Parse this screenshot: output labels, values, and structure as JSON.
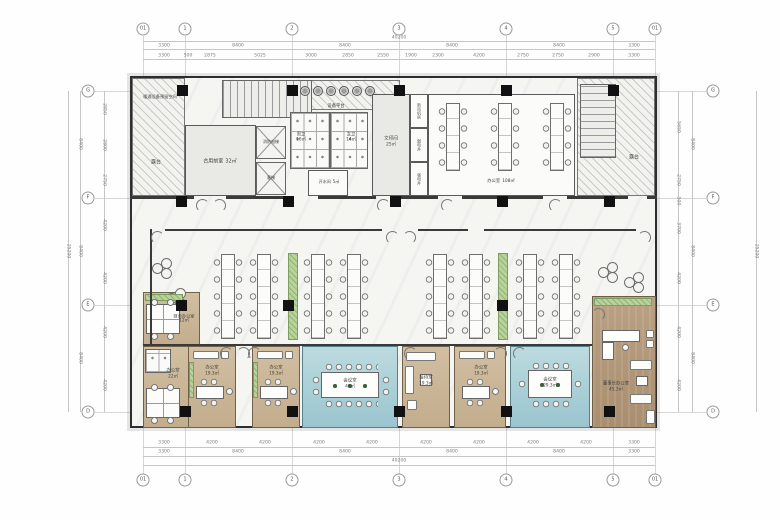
{
  "grid": {
    "top": [
      "01",
      "1",
      "2",
      "3",
      "4",
      "5",
      "01"
    ],
    "bottom": [
      "01",
      "1",
      "2",
      "3",
      "4",
      "5",
      "01"
    ],
    "left": [
      "G",
      "F",
      "E",
      "D"
    ],
    "right": [
      "G",
      "F",
      "E",
      "D"
    ]
  },
  "dims": {
    "top_total": "40200",
    "top_major": [
      "3300",
      "8400",
      "8400",
      "8400",
      "8400",
      "3300"
    ],
    "top_minor": [
      "3300",
      "500",
      "2875",
      "5025",
      "3000",
      "2850",
      "2550",
      "1900",
      "2300",
      "4200",
      "2750",
      "2750",
      "2900",
      "3300"
    ],
    "bottom_minor": [
      "3300",
      "4200",
      "4200",
      "4200",
      "4200",
      "4200",
      "4200",
      "4200",
      "4200",
      "3300"
    ],
    "bottom_major": [
      "3300",
      "8400",
      "8400",
      "8400",
      "8400",
      "3300"
    ],
    "bottom_total": "40200",
    "left_total": "25200",
    "left_major": [
      "8400",
      "8400",
      "8400"
    ],
    "left_minor": [
      "2850",
      "2800",
      "2750",
      "4200",
      "4200",
      "4200",
      "4200"
    ],
    "right_minor": [
      "5650",
      "2750",
      "500",
      "3700",
      "4200",
      "4200",
      "4200"
    ],
    "right_major": [
      "8400",
      "8400",
      "8400"
    ],
    "right_total": "25200"
  },
  "rooms": {
    "hvac_reserve": {
      "name": "暖通设备预留空间"
    },
    "terrace_left": {
      "name": "露台"
    },
    "shared_lobby": {
      "name": "合用前室",
      "area": "32㎡"
    },
    "fire_elevator": {
      "name": "消防电梯"
    },
    "passenger_elevator": {
      "name": "客梯"
    },
    "equipment_platform": {
      "name": "设备平台"
    },
    "mens_toilet": {
      "name": "男卫",
      "area": "16㎡"
    },
    "womens_toilet": {
      "name": "女卫",
      "area": "14㎡"
    },
    "hot_water": {
      "name": "开水间",
      "area": "5㎡"
    },
    "print_room": {
      "name": "文印间",
      "area": "25㎡"
    },
    "fresh_air": {
      "name": "新风机房"
    },
    "weak_power": {
      "name": "弱电井"
    },
    "strong_power": {
      "name": "强电井"
    },
    "office_top": {
      "name": "办公室",
      "area": "108㎡"
    },
    "terrace_right": {
      "name": "露台"
    },
    "finance_office": {
      "name": "财务办公室",
      "area": "12㎡"
    },
    "office_left": {
      "name": "办公室",
      "area": "22㎡"
    },
    "office_1": {
      "name": "办公室",
      "area": "19.3㎡"
    },
    "office_2": {
      "name": "办公室",
      "area": "19.3㎡"
    },
    "meeting_large": {
      "name": "会议室",
      "area": "40㎡"
    },
    "reception": {
      "name": "接待室",
      "area": "19.3㎡"
    },
    "office_3": {
      "name": "办公室",
      "area": "19.3㎡"
    },
    "meeting_small": {
      "name": "会议室",
      "area": "29.3㎡"
    },
    "chairman_office": {
      "name": "董事长办公室",
      "area": "45.3㎡"
    }
  },
  "colors": {
    "teal": "#a6ccd4",
    "tan": "#c9b49a",
    "wood": "#b29a7c",
    "green": "#b7d29a",
    "wall": "#3a3a3a",
    "column": "#111111"
  }
}
